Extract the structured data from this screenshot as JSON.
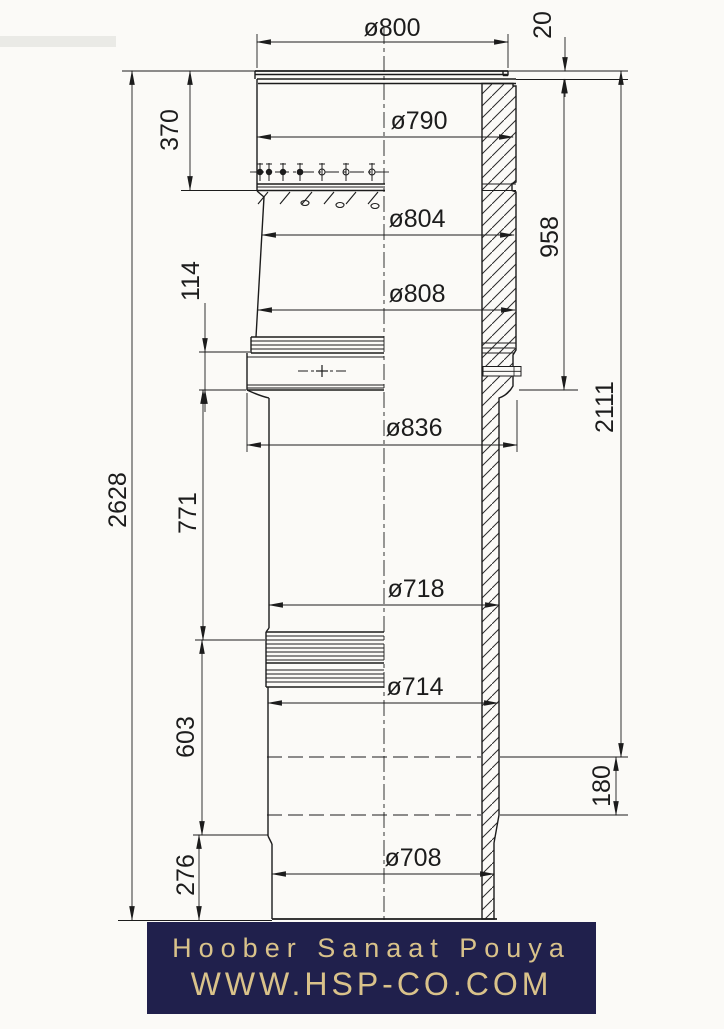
{
  "labels": {
    "d800": "ø800",
    "d790": "ø790",
    "d804": "ø804",
    "d808": "ø808",
    "d836": "ø836",
    "d718": "ø718",
    "d714": "ø714",
    "d708": "ø708",
    "l20": "20",
    "l370": "370",
    "l114": "114",
    "l958": "958",
    "l2111": "2111",
    "l2628": "2628",
    "l771": "771",
    "l603": "603",
    "l180": "180",
    "l276": "276"
  },
  "footer": {
    "company": "Hoober Sanaat Pouya",
    "website": "WWW.HSP-CO.COM",
    "background": "#20204c",
    "text_color": "#d9c28a"
  },
  "colors": {
    "line": "#1c1c1c",
    "background": "#fbfaf7"
  }
}
